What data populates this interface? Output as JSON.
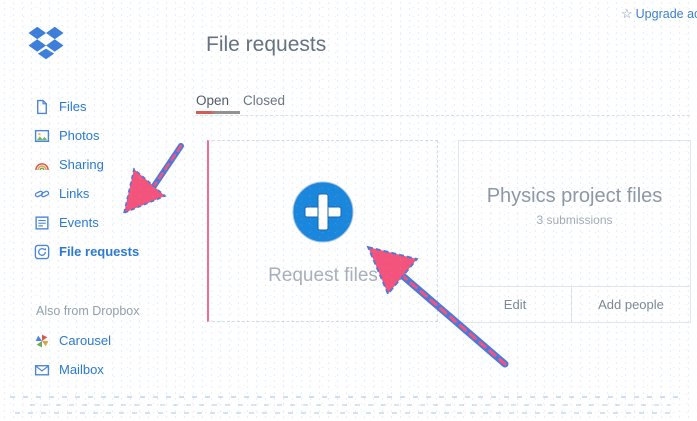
{
  "topbar": {
    "upgrade_label": "Upgrade ac",
    "star_icon": "☆"
  },
  "header": {
    "title": "File requests"
  },
  "sidebar": {
    "items": [
      {
        "label": "Files",
        "icon": "document-icon"
      },
      {
        "label": "Photos",
        "icon": "photo-icon"
      },
      {
        "label": "Sharing",
        "icon": "rainbow-icon"
      },
      {
        "label": "Links",
        "icon": "chain-link-icon"
      },
      {
        "label": "Events",
        "icon": "list-icon"
      },
      {
        "label": "File requests",
        "icon": "file-request-icon"
      }
    ],
    "section_label": "Also from Dropbox",
    "extra_items": [
      {
        "label": "Carousel",
        "icon": "carousel-pinwheel-icon"
      },
      {
        "label": "Mailbox",
        "icon": "mailbox-envelope-icon"
      }
    ]
  },
  "tabs": {
    "open": "Open",
    "closed": "Closed",
    "active_tab": "Open"
  },
  "main": {
    "request_card": {
      "label": "Request files",
      "icon": "plus-circle-icon"
    },
    "project_card": {
      "title": "Physics project files",
      "subtitle": "3 submissions",
      "edit_label": "Edit",
      "add_people_label": "Add people"
    }
  },
  "annotations": {
    "arrow_1_target": "sidebar file requests item",
    "arrow_2_target": "request files plus button",
    "color": "#f4547c",
    "outline_color": "#4a79d9"
  },
  "colors": {
    "dropbox_blue": "#1b87dc",
    "link_blue": "#2a7ad2"
  }
}
